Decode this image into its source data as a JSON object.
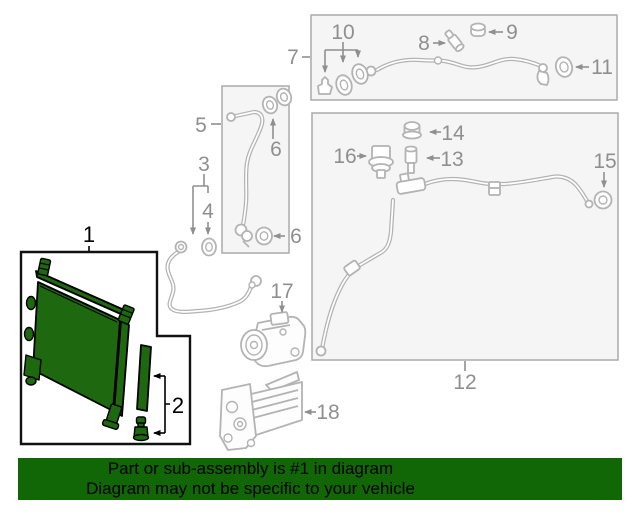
{
  "banner": {
    "line1": "Part or sub-assembly is #1 in diagram",
    "line2": "Diagram may not be specific to your vehicle"
  },
  "highlight": {
    "part_number": "1"
  },
  "callouts": {
    "c1": "1",
    "c2": "2",
    "c3": "3",
    "c4": "4",
    "c5": "5",
    "c6_upper": "6",
    "c6_lower": "6",
    "c7": "7",
    "c8": "8",
    "c9": "9",
    "c10": "10",
    "c11": "11",
    "c12": "12",
    "c13": "13",
    "c14": "14",
    "c15": "15",
    "c16": "16",
    "c17": "17",
    "c18": "18"
  },
  "colors": {
    "highlight_green": "#1e690f",
    "banner_green": "#116606",
    "banner_text": "#000000",
    "line_gray": "#b3b3b3",
    "label_gray": "#8f8f8f",
    "black_outline": "#000000",
    "box_fill": "#f5f5f5",
    "box_border": "#aaaaaa"
  },
  "icons": {
    "o_ring": "o-ring-icon",
    "arrow": "callout-arrow-icon"
  }
}
